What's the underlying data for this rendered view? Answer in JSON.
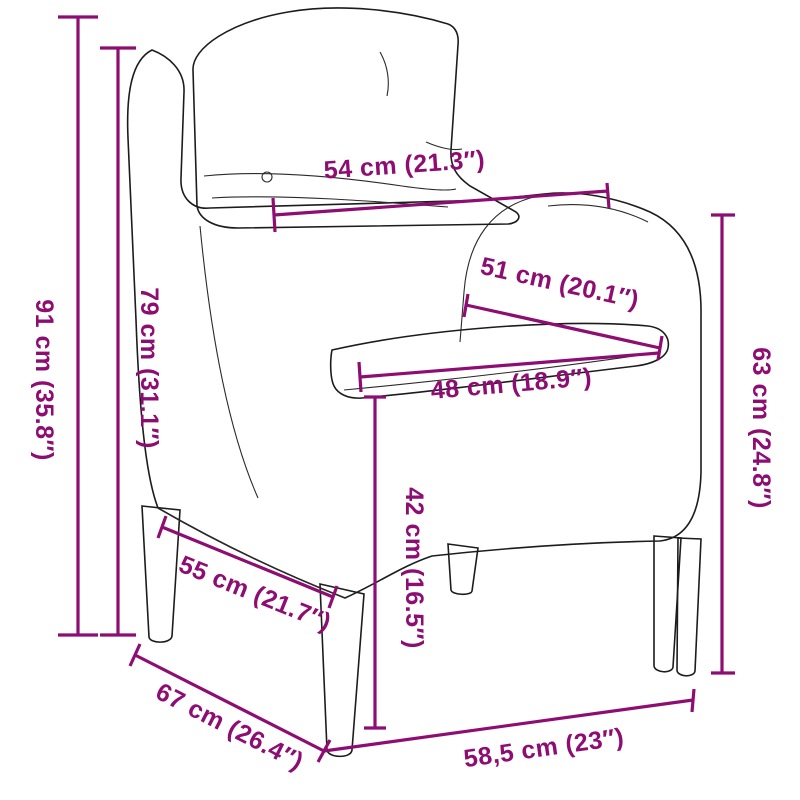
{
  "diagram": {
    "subject": "rattan garden armchair with back and seat cushions (technical line drawing)",
    "accent_color": "#8E0D72",
    "outline_color": "#1c1c1c",
    "background_color": "#ffffff",
    "measurements": [
      {
        "id": "overall-height",
        "label": "91 cm (35.8″)"
      },
      {
        "id": "backrest-height",
        "label": "79 cm (31.1″)"
      },
      {
        "id": "backrest-top-width",
        "label": "54 cm (21.3″)"
      },
      {
        "id": "inner-width",
        "label": "51 cm (20.1″)"
      },
      {
        "id": "seat-width",
        "label": "48 cm (18.9″)"
      },
      {
        "id": "seat-height",
        "label": "42 cm (16.5″)"
      },
      {
        "id": "seat-depth",
        "label": "55 cm (21.7″)"
      },
      {
        "id": "overall-depth",
        "label": "67 cm (26.4″)"
      },
      {
        "id": "base-width",
        "label": "58,5 cm (23″)"
      },
      {
        "id": "armrest-height",
        "label": "63 cm (24.8″)"
      }
    ]
  }
}
